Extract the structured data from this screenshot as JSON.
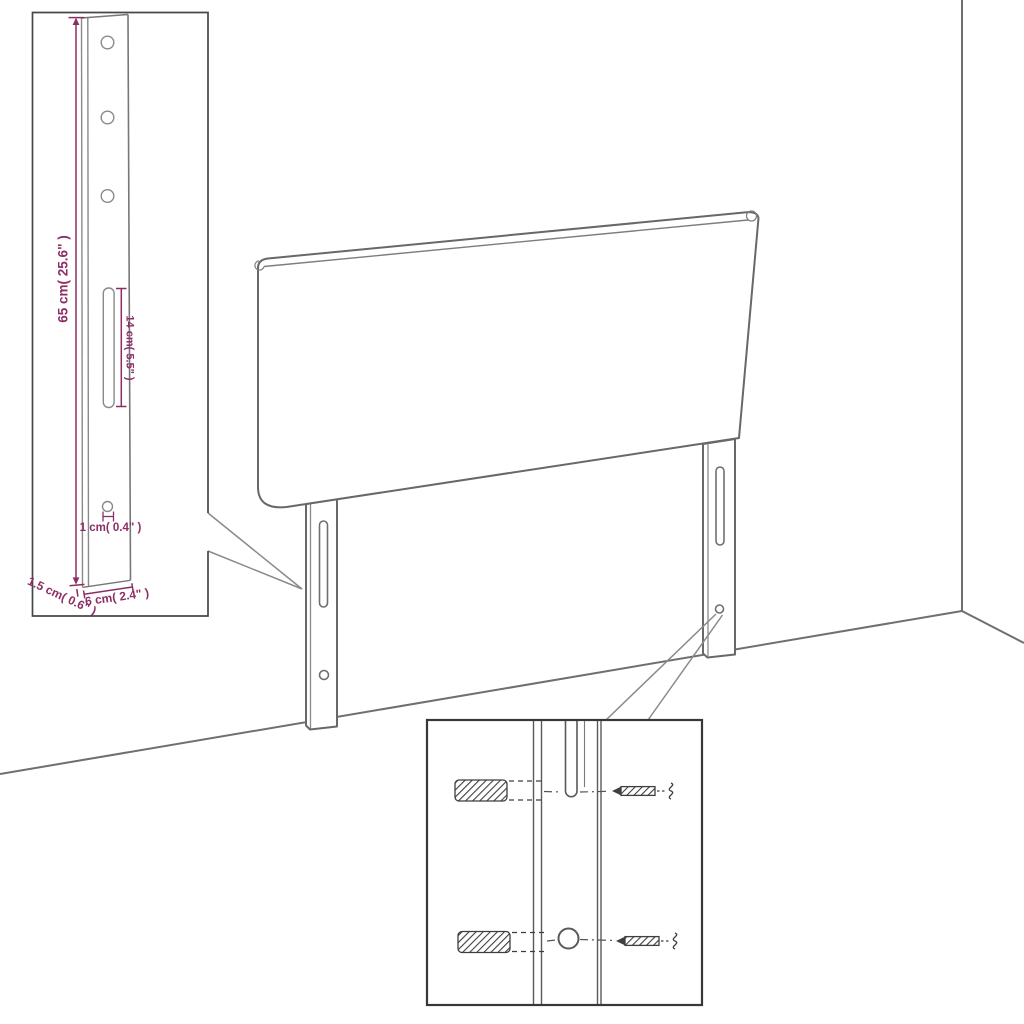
{
  "labels": {
    "leg_height": "65 cm( 25.6\" )",
    "slot_length": "14 cm( 5.5\" )",
    "hole_diameter": "1 cm( 0.4\" )",
    "leg_thickness": "1.5 cm( 0.6\" )",
    "leg_width": "6 cm( 2.4\" )"
  },
  "colors": {
    "dimension_purple": "#8C2E65",
    "drawing_gray": "#686868",
    "light_gray": "#8a8a8a",
    "inset_border": "#3d3d3d",
    "hardware_dark": "#3f3f3f",
    "background": "#ffffff"
  },
  "components": {
    "main_view": "headboard-with-two-mounting-legs-against-wall-corner",
    "top_left_inset": "leg-side-view-with-dimensions",
    "bottom_inset": "wall-anchor-and-screw-mounting-detail"
  }
}
